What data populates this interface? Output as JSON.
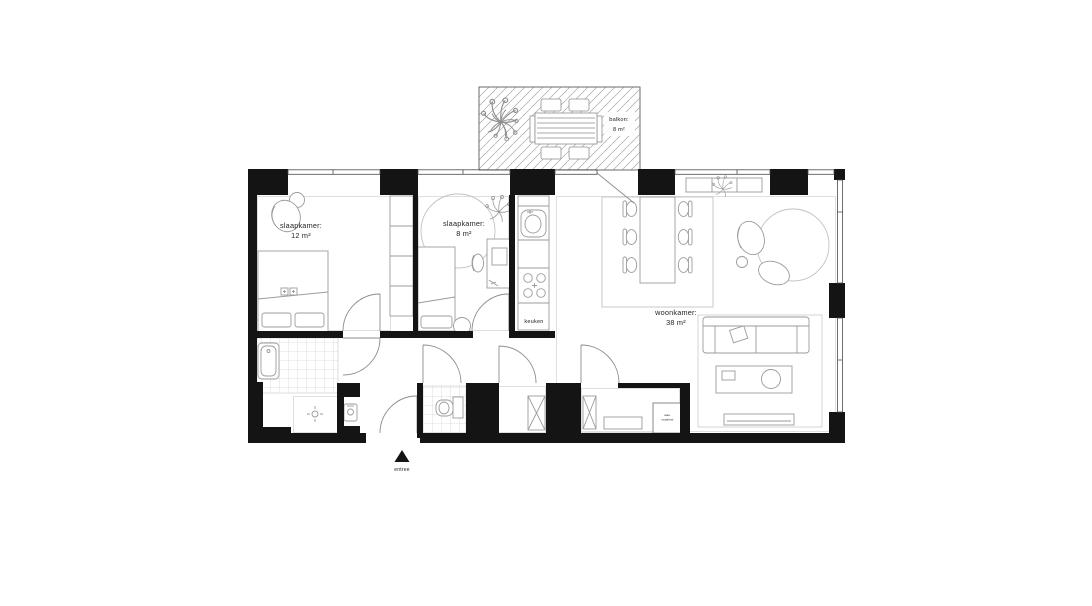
{
  "colors": {
    "wall": "#141414",
    "furniture_line": "#9b9b9b",
    "thin_outline": "#d7d7d7",
    "door_line": "#8d8d8d",
    "hatch_line": "#a9a9a9",
    "tile_line": "#c6c6c6",
    "text": "#232323"
  },
  "rooms": {
    "bedroom1": {
      "label": "slaapkamer:",
      "area": "12 m²"
    },
    "bedroom2": {
      "label": "slaapkamer:",
      "area": "8 m²"
    },
    "kitchen": {
      "label": "keuken"
    },
    "living_room": {
      "label": "woonkamer:",
      "area": "38 m²"
    },
    "balcony": {
      "label": "balkon:",
      "area": "8 m²"
    }
  },
  "entrance": {
    "label": "entree",
    "marker_icon": "entrance-arrow-icon"
  },
  "appliances": {
    "washer": {
      "line1": "was-",
      "line2": "machine"
    }
  },
  "icons": [
    "plant-icon",
    "bathtub-icon",
    "shower-drain-icon",
    "toilet-icon",
    "sink-icon",
    "stove-icon",
    "washbasin-icon",
    "entrance-arrow-icon"
  ]
}
